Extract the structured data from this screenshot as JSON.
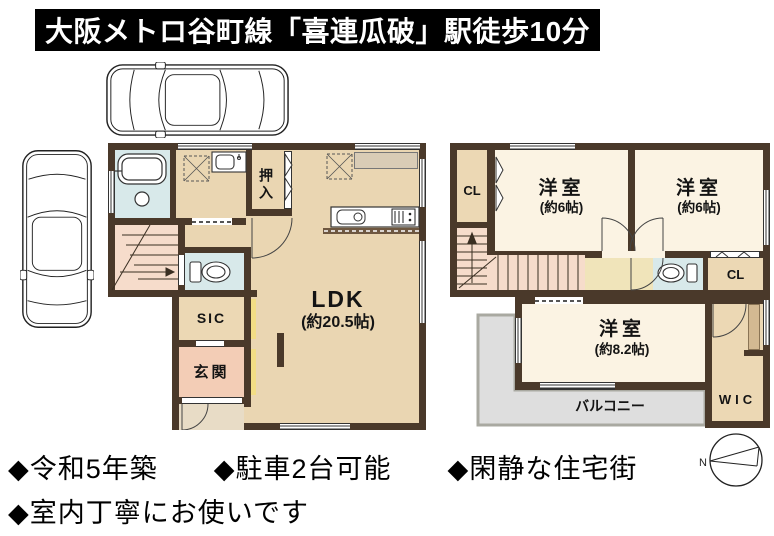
{
  "header": {
    "title": "大阪メトロ谷町線「喜連瓜破」駅徒歩10分"
  },
  "floor1": {
    "ldk": {
      "label": "LDK",
      "size": "(約20.5帖)"
    },
    "oshiire": "押入",
    "sic": "SIC",
    "genkan": "玄関"
  },
  "floor2": {
    "cl_left": "CL",
    "cl_right": "CL",
    "bedroom1": {
      "label": "洋室",
      "size": "(約6帖)"
    },
    "bedroom2": {
      "label": "洋室",
      "size": "(約6帖)"
    },
    "bedroom3": {
      "label": "洋室",
      "size": "(約8.2帖)"
    },
    "balcony": "バルコニー",
    "wic": "WIC"
  },
  "features": {
    "line1": "◆令和5年築　　◆駐車2台可能　　◆閑静な住宅街",
    "line2": "◆室内丁寧にお使いです"
  },
  "compass": {
    "north": "N"
  },
  "colors": {
    "wall": "#4a392a",
    "floor": "#ead6b2",
    "room_cream": "#fbf3e3",
    "bath_blue": "#d8e9ea",
    "genkan_salmon": "#f3cdb6",
    "stairs_pink": "#f6dccb",
    "hall_yellow": "#f0e4ba",
    "balcony_gray": "#dedede",
    "accent_yellow": "#f2dd85",
    "banner_bg": "#000000",
    "banner_text": "#ffffff"
  }
}
